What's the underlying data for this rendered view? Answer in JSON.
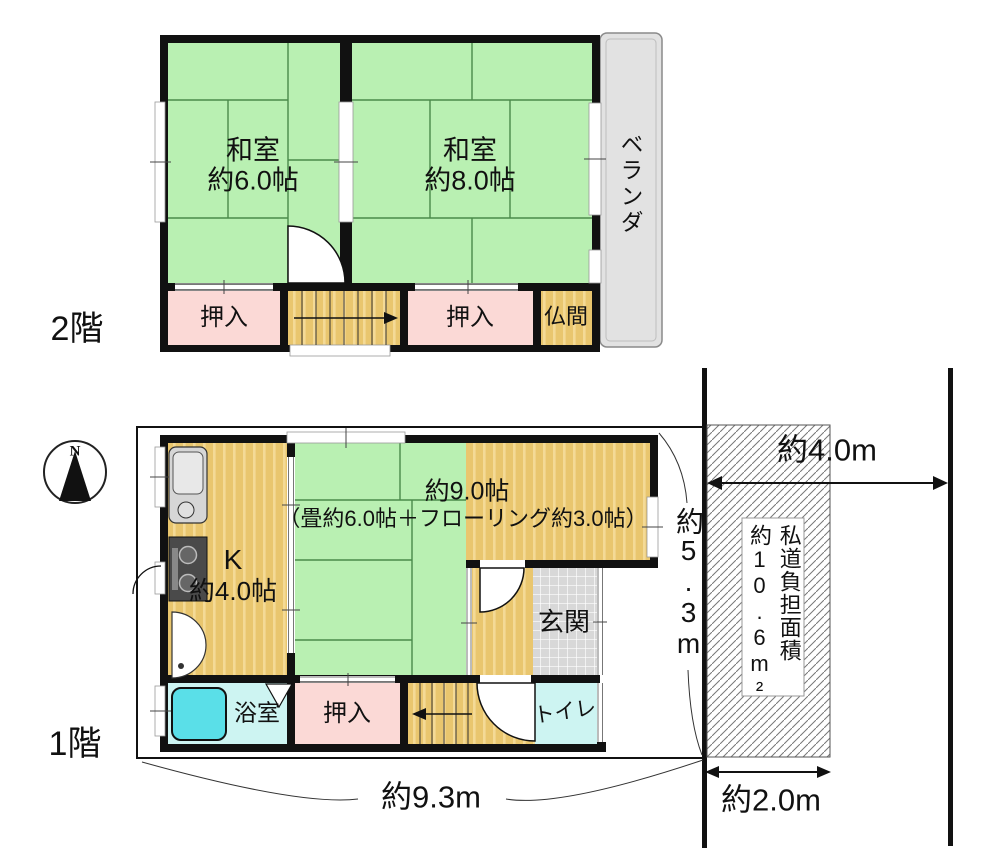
{
  "floor2": {
    "label": "2階",
    "washitsu6_name": "和室",
    "washitsu6_size": "約6.0帖",
    "washitsu8_name": "和室",
    "washitsu8_size": "約8.0帖",
    "oshiire_left": "押入",
    "oshiire_right": "押入",
    "butsuma": "仏間",
    "veranda": "ベランダ"
  },
  "floor1": {
    "label": "1階",
    "kitchen_name": "K",
    "kitchen_size": "約4.0帖",
    "main_size": "約9.0帖",
    "main_detail": "（畳約6.0帖＋フローリング約3.0帖）",
    "genkan": "玄関",
    "oshiire": "押入",
    "bath": "浴室",
    "toilet": "トイレ"
  },
  "site": {
    "lot_width": "約9.3m",
    "lot_depth": "約5.3m",
    "road_span": "約4.0m",
    "road_width": "約2.0m",
    "burden_title": "私道負担面積",
    "burden_area": "約10.6m²",
    "compass_north": "N"
  },
  "colors": {
    "tatami_green": "#b9f0b2",
    "tatami_line": "#4a8a4a",
    "wood_tan": "#e9c66e",
    "wood_stripe": "#f4da96",
    "closet_pink": "#fbd9d6",
    "wet_area_cyan": "#cdf4f2",
    "bathtub_cyan": "#5adfe8",
    "genkan_gray": "#d8d8d8",
    "veranda_gray": "#e2e2e2",
    "wall_black": "#111111"
  }
}
